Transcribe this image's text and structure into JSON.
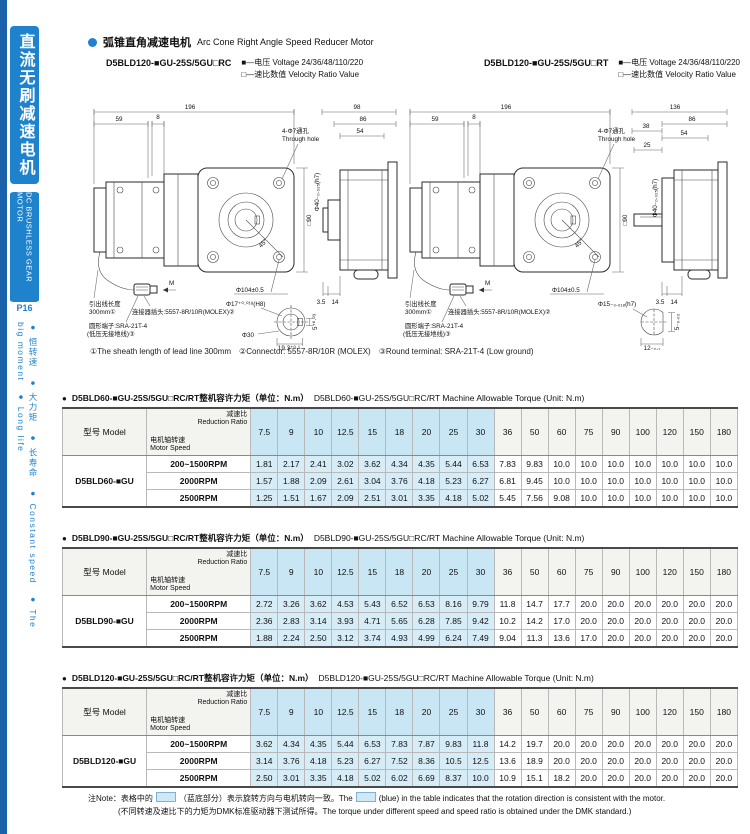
{
  "colors": {
    "accent_blue": "#1f82cc",
    "edge_blue": "#1a61a9",
    "table_highlight": "#cfe9f6"
  },
  "sidebar": {
    "title_cn": "直流无刷减速电机",
    "title_en": "DC BRUSHLESS GEAR MOTOR",
    "page": "P16",
    "features": "● 恒转速　● 大力矩　● 长寿命　● Constant speed　● The big moment　● Long life"
  },
  "header": {
    "title_cn": "弧锥直角减速电机",
    "title_en": "Arc Cone Right Angle Speed Reducer Motor",
    "left_model": "D5BLD120-■GU-25S/5GU□RC",
    "right_model": "D5BLD120-■GU-25S/5GU□RT",
    "voltage_line": "■—电压 Voltage 24/36/48/110/220",
    "ratio_line": "□—速比数值 Velocity Ratio Value"
  },
  "drawings": {
    "footnote": "①The sheath length of lead line 300mm　②Connector: 5557-8R/10R (MOLEX)　③Round terminal: SRA-21T-4 (Low ground)",
    "left": {
      "dim_total": "196",
      "dim_59": "59",
      "dim_8": "8",
      "hole_cn": "4-Φ7通孔",
      "hole_en": "Through hole",
      "square": "□90",
      "angle": "45°",
      "pilot": "Φ104±0.5",
      "m": "M",
      "side_total": "98",
      "side_86": "86",
      "side_54": "54",
      "side_35": "3.5",
      "side_14": "14",
      "boss": "Φ40₋₀.₀₂₅(h7)",
      "lead_cn": "引出线长度",
      "lead_len": "300mm①",
      "connector": "连接器插头:5557-8R/10R(MOLEX)②",
      "terminal_1": "圆形端子:SRA-21T-4",
      "terminal_2": "(低压无接地线)③",
      "detail_bore": "Φ17⁺⁰·⁰¹⁸(H8)",
      "detail_outer": "Φ30",
      "detail_w": "19.3⁺⁰·¹",
      "detail_key": "5⁺⁰·⁰³"
    },
    "right": {
      "dim_total": "196",
      "dim_59": "59",
      "dim_8": "8",
      "hole_cn": "4-Φ7通孔",
      "hole_en": "Through hole",
      "square": "□90",
      "angle": "45°",
      "pilot": "Φ104±0.5",
      "m": "M",
      "side_total": "136",
      "side_86": "86",
      "side_38": "38",
      "side_54": "54",
      "side_25": "25",
      "side_35": "3.5",
      "side_14": "14",
      "boss": "Φ40₋₀.₀₂₅(h7)",
      "lead_cn": "引出线长度",
      "lead_len": "300mm①",
      "connector": "连接器插头:5557-8R/10R(MOLEX)②",
      "terminal_1": "圆形端子:SRA-21T-4",
      "terminal_2": "(低压无接地线)③",
      "detail_shaft": "Φ15₋₀.₀₁₈(h7)",
      "detail_flat": "12₋₀.₁",
      "detail_key": "5₋₀.₀₃"
    }
  },
  "table_header": {
    "model_label": "型号 Model",
    "ratio_label": "减速比 Reduction Ratio",
    "speed_label": "电机轴转速 Motor Speed",
    "ratios": [
      "7.5",
      "9",
      "10",
      "12.5",
      "15",
      "18",
      "20",
      "25",
      "30",
      "36",
      "50",
      "60",
      "75",
      "90",
      "100",
      "120",
      "150",
      "180"
    ],
    "highlight_count": 9
  },
  "tables": [
    {
      "title_cn": "D5BLD60-■GU-25S/5GU□RC/RT整机容许力矩（单位：N.m）",
      "title_en": "D5BLD60-■GU-25S/5GU□RC/RT Machine Allowable Torque (Unit: N.m)",
      "model": "D5BLD60-■GU",
      "rows": [
        {
          "speed": "200~1500RPM",
          "values": [
            "1.81",
            "2.17",
            "2.41",
            "3.02",
            "3.62",
            "4.34",
            "4.35",
            "5.44",
            "6.53",
            "7.83",
            "9.83",
            "10.0",
            "10.0",
            "10.0",
            "10.0",
            "10.0",
            "10.0",
            "10.0"
          ]
        },
        {
          "speed": "2000RPM",
          "values": [
            "1.57",
            "1.88",
            "2.09",
            "2.61",
            "3.04",
            "3.76",
            "4.18",
            "5.23",
            "6.27",
            "6.81",
            "9.45",
            "10.0",
            "10.0",
            "10.0",
            "10.0",
            "10.0",
            "10.0",
            "10.0"
          ]
        },
        {
          "speed": "2500RPM",
          "values": [
            "1.25",
            "1.51",
            "1.67",
            "2.09",
            "2.51",
            "3.01",
            "3.35",
            "4.18",
            "5.02",
            "5.45",
            "7.56",
            "9.08",
            "10.0",
            "10.0",
            "10.0",
            "10.0",
            "10.0",
            "10.0"
          ]
        }
      ]
    },
    {
      "title_cn": "D5BLD90-■GU-25S/5GU□RC/RT整机容许力矩（单位：N.m）",
      "title_en": "D5BLD90-■GU-25S/5GU□RC/RT Machine Allowable Torque (Unit: N.m)",
      "model": "D5BLD90-■GU",
      "rows": [
        {
          "speed": "200~1500RPM",
          "values": [
            "2.72",
            "3.26",
            "3.62",
            "4.53",
            "5.43",
            "6.52",
            "6.53",
            "8.16",
            "9.79",
            "11.8",
            "14.7",
            "17.7",
            "20.0",
            "20.0",
            "20.0",
            "20.0",
            "20.0",
            "20.0"
          ]
        },
        {
          "speed": "2000RPM",
          "values": [
            "2.36",
            "2.83",
            "3.14",
            "3.93",
            "4.71",
            "5.65",
            "6.28",
            "7.85",
            "9.42",
            "10.2",
            "14.2",
            "17.0",
            "20.0",
            "20.0",
            "20.0",
            "20.0",
            "20.0",
            "20.0"
          ]
        },
        {
          "speed": "2500RPM",
          "values": [
            "1.88",
            "2.24",
            "2.50",
            "3.12",
            "3.74",
            "4.93",
            "4.99",
            "6.24",
            "7.49",
            "9.04",
            "11.3",
            "13.6",
            "17.0",
            "20.0",
            "20.0",
            "20.0",
            "20.0",
            "20.0"
          ]
        }
      ]
    },
    {
      "title_cn": "D5BLD120-■GU-25S/5GU□RC/RT整机容许力矩（单位：N.m）",
      "title_en": "D5BLD120-■GU-25S/5GU□RC/RT Machine Allowable Torque (Unit: N.m)",
      "model": "D5BLD120-■GU",
      "rows": [
        {
          "speed": "200~1500RPM",
          "values": [
            "3.62",
            "4.34",
            "4.35",
            "5.44",
            "6.53",
            "7.83",
            "7.87",
            "9.83",
            "11.8",
            "14.2",
            "19.7",
            "20.0",
            "20.0",
            "20.0",
            "20.0",
            "20.0",
            "20.0",
            "20.0"
          ]
        },
        {
          "speed": "2000RPM",
          "values": [
            "3.14",
            "3.76",
            "4.18",
            "5.23",
            "6.27",
            "7.52",
            "8.36",
            "10.5",
            "12.5",
            "13.6",
            "18.9",
            "20.0",
            "20.0",
            "20.0",
            "20.0",
            "20.0",
            "20.0",
            "20.0"
          ]
        },
        {
          "speed": "2500RPM",
          "values": [
            "2.50",
            "3.01",
            "3.35",
            "4.18",
            "5.02",
            "6.02",
            "6.69",
            "8.37",
            "10.0",
            "10.9",
            "15.1",
            "18.2",
            "20.0",
            "20.0",
            "20.0",
            "20.0",
            "20.0",
            "20.0"
          ]
        }
      ]
    }
  ],
  "note": {
    "l1a": "注Note：表格中的",
    "l1b": "（蓝底部分）表示旋转方向与电机转向一致。The",
    "l1c": "(blue) in the table indicates that the rotation direction is consistent with the motor.",
    "l2": "(不同转速及速比下的力矩为DMK标准驱动器下测试所得。The torque under different speed and speed ratio is obtained under the DMK standard.)"
  }
}
